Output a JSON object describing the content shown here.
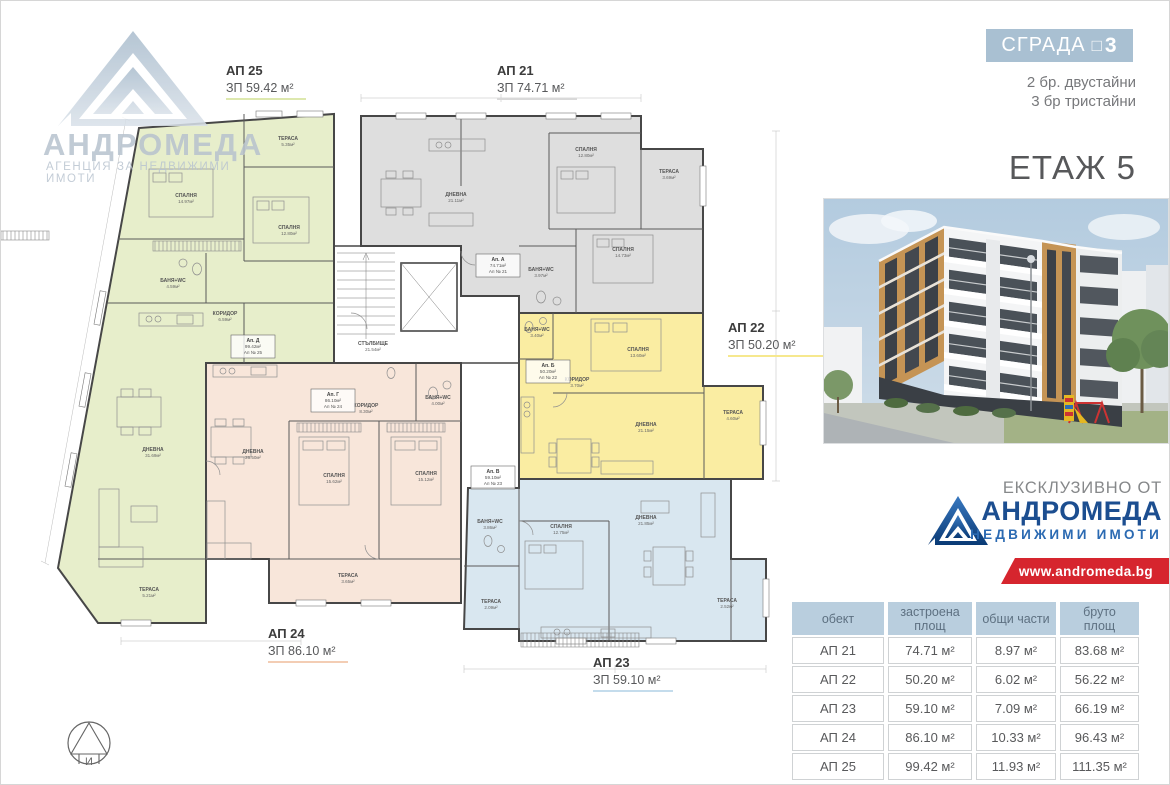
{
  "header": {
    "badge_label": "СГРАДА",
    "badge_glyph": "□",
    "badge_number": "3",
    "units_line1": "2 бр. двустайни",
    "units_line2": "3 бр тристайни",
    "floor_title": "ЕТАЖ 5"
  },
  "watermark": {
    "brand": "АНДРОМЕДА",
    "subtitle": "АГЕНЦИЯ ЗА НЕДВИЖИМИ ИМОТИ"
  },
  "exclusive": {
    "heading": "ЕКСКЛУЗИВНО ОТ",
    "brand": "АНДРОМЕДА",
    "brand_sub": "НЕДВИЖИМИ ИМОТИ",
    "website": "www.andromeda.bg"
  },
  "plan": {
    "stairwell_name": "СТЪЛБИЩЕ",
    "stairwell_area": "21.54м²",
    "apartments": [
      {
        "id": "АП 21",
        "zp": "ЗП 74.71 м²",
        "color": "#dedede",
        "tag1": "Ап. А",
        "tag2": "74.71м²",
        "tag3": "Ап № 21",
        "rooms": [
          {
            "n": "ДНЕВНА",
            "a": "21.11м²"
          },
          {
            "n": "СПАЛНЯ",
            "a": "12.80м²"
          },
          {
            "n": "СПАЛНЯ",
            "a": "14.73м²"
          },
          {
            "n": "ТЕРАСА",
            "a": "3.69м²"
          },
          {
            "n": "БАНЯ+WC",
            "a": "3.97м²"
          }
        ]
      },
      {
        "id": "АП 22",
        "zp": "ЗП 50.20 м²",
        "color": "#faeda2",
        "tag1": "Ап. Б",
        "tag2": "50.20м²",
        "tag3": "Ап № 22",
        "rooms": [
          {
            "n": "СПАЛНЯ",
            "a": "13.60м²"
          },
          {
            "n": "ДНЕВНА",
            "a": "21.15м²"
          },
          {
            "n": "ТЕРАСА",
            "a": "4.60м²"
          },
          {
            "n": "БАНЯ+WC",
            "a": "3.40м²"
          },
          {
            "n": "КОРИДОР",
            "a": "3.70м²"
          }
        ]
      },
      {
        "id": "АП 23",
        "zp": "ЗП 59.10 м²",
        "color": "#d9e7f0",
        "tag1": "Ап. В",
        "tag2": "59.10м²",
        "tag3": "Ап № 23",
        "rooms": [
          {
            "n": "ДНЕВНА",
            "a": "21.85м²"
          },
          {
            "n": "СПАЛНЯ",
            "a": "12.75м²"
          },
          {
            "n": "БАНЯ+WC",
            "a": "3.86м²"
          },
          {
            "n": "ТЕРАСА",
            "a": "2.09м²"
          },
          {
            "n": "ТЕРАСА",
            "a": "2.52м²"
          }
        ]
      },
      {
        "id": "АП 24",
        "zp": "ЗП 86.10 м²",
        "color": "#f8e6da",
        "tag1": "Ап. Г",
        "tag2": "86.10м²",
        "tag3": "Ап № 24",
        "rooms": [
          {
            "n": "ДНЕВНА",
            "a": "26.50м²"
          },
          {
            "n": "СПАЛНЯ",
            "a": "15.62м²"
          },
          {
            "n": "СПАЛНЯ",
            "a": "15.12м²"
          },
          {
            "n": "КОРИДОР",
            "a": "8.30м²"
          },
          {
            "n": "БАНЯ+WC",
            "a": "4.00м²"
          },
          {
            "n": "ТЕРАСА",
            "a": "3.65м²"
          }
        ]
      },
      {
        "id": "АП 25",
        "zp": "ЗП 59.42 м²",
        "color": "#e7eecb",
        "tag1": "Ап. Д",
        "tag2": "99.42м²",
        "tag3": "Ап № 25",
        "rooms": [
          {
            "n": "ТЕРАСА",
            "a": "5.35м²"
          },
          {
            "n": "СПАЛНЯ",
            "a": "14.97м²"
          },
          {
            "n": "СПАЛНЯ",
            "a": "12.80м²"
          },
          {
            "n": "БАНЯ+WC",
            "a": "4.59м²"
          },
          {
            "n": "КОРИДОР",
            "a": "6.59м²"
          },
          {
            "n": "ДНЕВНА",
            "a": "31.69м²"
          },
          {
            "n": "ТЕРАСА",
            "a": "5.21м²"
          }
        ]
      }
    ]
  },
  "table": {
    "headers": [
      "обект",
      "застроена\nплощ",
      "общи части",
      "бруто\nплощ"
    ],
    "rows": [
      [
        "АП 21",
        "74.71 м²",
        "8.97 м²",
        "83.68 м²"
      ],
      [
        "АП 22",
        "50.20 м²",
        "6.02 м²",
        "56.22 м²"
      ],
      [
        "АП 23",
        "59.10 м²",
        "7.09 м²",
        "66.19 м²"
      ],
      [
        "АП 24",
        "86.10 м²",
        "10.33 м²",
        "96.43 м²"
      ],
      [
        "АП 25",
        "99.42 м²",
        "11.93 м²",
        "111.35 м²"
      ]
    ]
  },
  "colors": {
    "badge_bg": "#a9c0d2",
    "table_header_bg": "#b9cede",
    "accent_red": "#d6252e",
    "brand_blue": "#1c4e90",
    "watermark": "#b7c2ce",
    "ap21": "#dedede",
    "ap22": "#faeda2",
    "ap23": "#d9e7f0",
    "ap24": "#f8e6da",
    "ap25": "#e7eecb"
  }
}
